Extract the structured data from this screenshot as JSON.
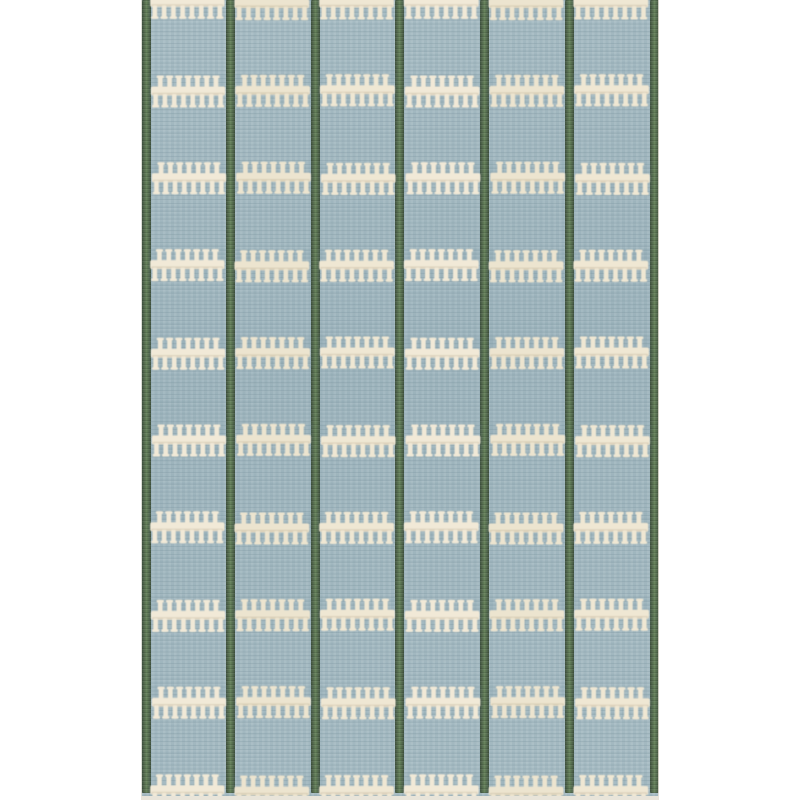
{
  "scene": {
    "type": "natural-image",
    "subject": "Scandinavian flatweave rug",
    "description": "Full-length product photo of a light dusty-blue flatweave wool rug with seven dark sage-green vertical stripes and ten rows of cream comb-stitch horizontal bands forming a six-column grid; the rug is cropped at the top and bottom edges and sits on a plain white background.",
    "background_color": "#ffffff"
  },
  "rug": {
    "left_px": 141,
    "top_px": 0,
    "width_px": 518,
    "height_px": 800,
    "colors": {
      "field_blue": "#a4bac2",
      "weave_shadow_blue": "#7d96a0",
      "weave_light_blue": "#b6c8cd",
      "stripe_green": "#5c7654",
      "stripe_green_edge": "#3f5140",
      "stripe_green_center": "#6a855f",
      "stitch_cream": "#f1e9d7",
      "stitch_cream_alt1": "#ece4cf",
      "stitch_cream_alt2": "#efe7d3",
      "stitch_shadow": "rgba(140,118,84,0.18)",
      "band_halo_blue": "rgba(116,143,155,0.10)",
      "selvage": "#e8e4d9"
    },
    "pattern": {
      "column_count": 6,
      "stripe_centers_px": [
        5,
        89.25,
        174,
        258.75,
        343.5,
        428.25,
        513
      ],
      "stripe_width_px": 9,
      "stripe_bottom_px": 793,
      "band_row_centers_px": [
        3,
        90.4,
        177.8,
        265.2,
        352.6,
        440,
        527.4,
        614.8,
        702.2,
        790.5
      ],
      "bar_height_px": 9,
      "cell_inset_px": 5,
      "upper_tooth_count": 7,
      "lower_tooth_count": 8,
      "tooth_stem_width_px": 4.6,
      "upper_tooth_height_px": 11,
      "lower_tooth_height_px": 12,
      "tooth_cap_width_px": 7.2,
      "tooth_cap_height_px": 2.6,
      "selvage_bottom_height_px": 4,
      "selvage_side_width_px": 1.3
    }
  }
}
